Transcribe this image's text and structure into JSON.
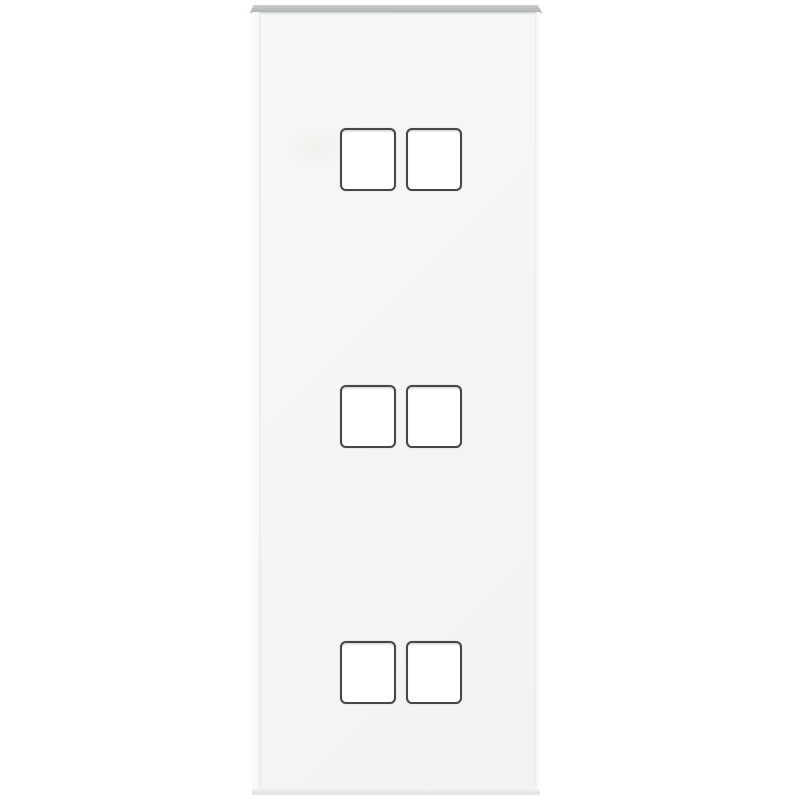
{
  "scene": {
    "background_color": "#ffffff"
  },
  "product": {
    "kind": "faceplate-panel-photo",
    "rows": 3,
    "columns": 2,
    "cutouts_total": 6,
    "colors": {
      "panel_face": "#f5f5f3",
      "panel_top_edge": "#b4b8bb",
      "panel_bottom_edge": "#e5e6e6",
      "panel_side_highlight": "#fbfbfa",
      "cutout_fill": "#ffffff",
      "cutout_border": "#474747"
    }
  }
}
